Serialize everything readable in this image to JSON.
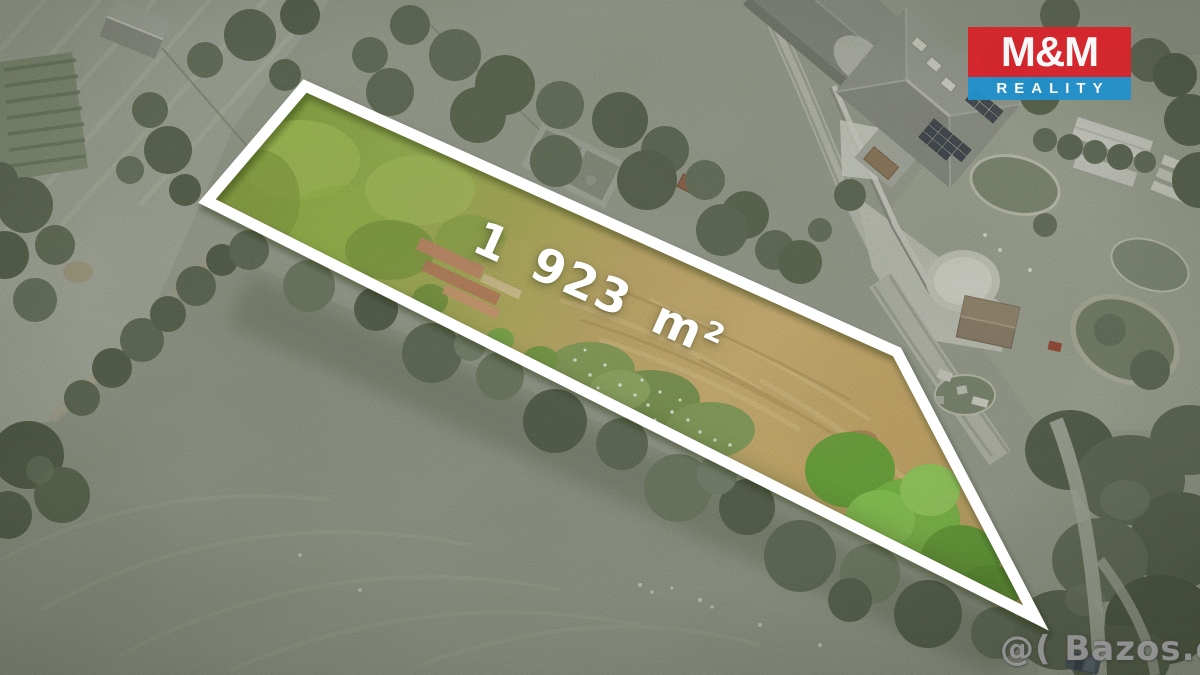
{
  "overlay": {
    "area_label": "1 923 m²",
    "label_color": "#ffffff"
  },
  "logo": {
    "top_text": "M&M",
    "bottom_text": "REALITY",
    "red_color": "#d8232a",
    "blue_color": "#2191cc",
    "text_color": "#ffffff"
  },
  "watermark": {
    "text": "@( Bazos.cz"
  },
  "plot": {
    "outline_color": "#ffffff",
    "interior_palette": {
      "grass_green": "#8fae47",
      "dry_grass_tan": "#c6a96b",
      "shrub_green": "#7e9a52",
      "tip_tree_green": "#6fb53c",
      "rubble_red": "#bd7a5e"
    },
    "surroundings_tone": "#949a8b"
  }
}
